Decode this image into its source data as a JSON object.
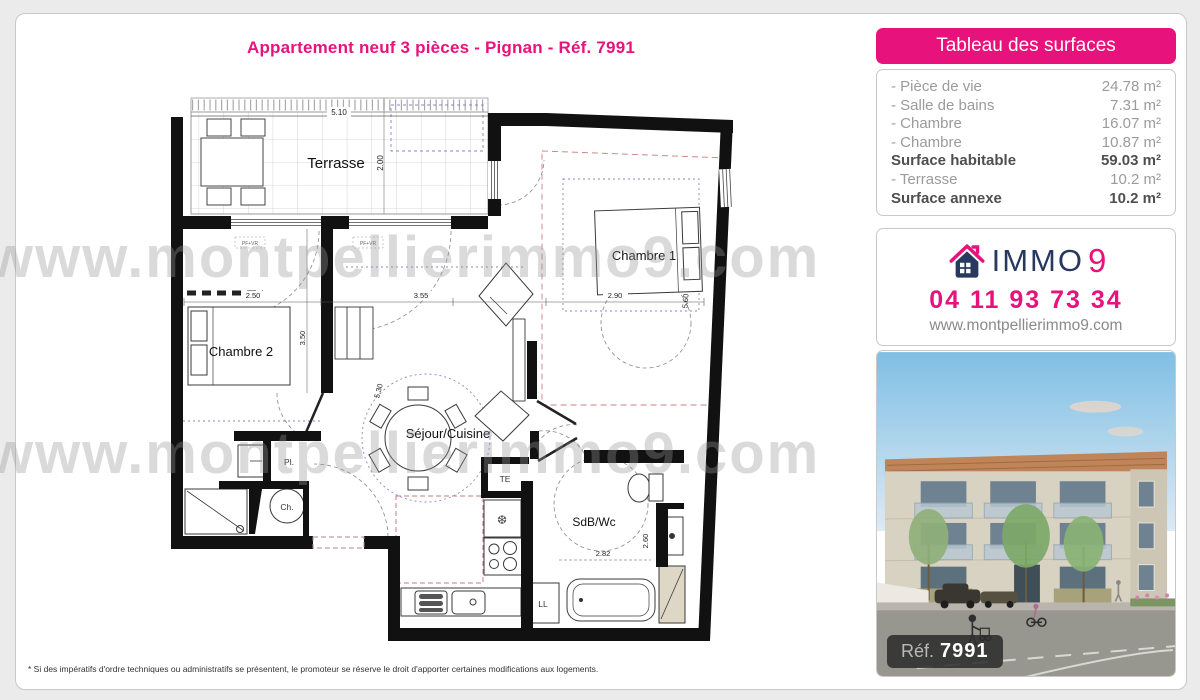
{
  "page": {
    "title": "Appartement neuf 3 pièces - Pignan - Réf. 7991"
  },
  "watermark": {
    "text": "www.montpellierimmo9.com"
  },
  "surfaces": {
    "header": "Tableau des surfaces",
    "rows": [
      {
        "label": "- Pièce de vie",
        "value": "24.78 m²",
        "bold": false
      },
      {
        "label": "- Salle de bains",
        "value": "7.31 m²",
        "bold": false
      },
      {
        "label": "- Chambre",
        "value": "16.07 m²",
        "bold": false
      },
      {
        "label": "- Chambre",
        "value": "10.87 m²",
        "bold": false
      },
      {
        "label": "Surface habitable",
        "value": "59.03 m²",
        "bold": true
      },
      {
        "label": "- Terrasse",
        "value": "10.2 m²",
        "bold": false
      },
      {
        "label": "Surface annexe",
        "value": "10.2 m²",
        "bold": true
      }
    ]
  },
  "agency": {
    "brand_immo": "IMMO",
    "brand_9": "9",
    "phone": "04 11 93 73 34",
    "website": "www.montpellierimmo9.com"
  },
  "photo": {
    "ref_label": "Réf.",
    "ref_value": "7991"
  },
  "plan": {
    "rooms": {
      "terrasse": "Terrasse",
      "chambre1": "Chambre 1",
      "chambre2": "Chambre 2",
      "sejour": "Séjour/Cuisine",
      "sdb": "SdB/Wc",
      "placard": "Pl.",
      "chauffe": "Ch.",
      "te": "TE",
      "ll": "LL"
    },
    "dims": {
      "terrace_w": "5.10",
      "terrace_d": "2.00",
      "win_left": "2.50",
      "win_mid": "3.55",
      "bed1_w": "2.90",
      "ch2_d": "3.50",
      "sejour_d": "5.30",
      "ch1_d": "5.60",
      "sdb_w": "2.82",
      "sdb_d": "2.60"
    },
    "window_tag": "PF+VR"
  },
  "footer": {
    "disclaimer": "* Si des impératifs d'ordre techniques ou administratifs se présentent, le promoteur se réserve le droit d'apporter certaines modifications aux logements."
  },
  "colors": {
    "pink": "#e8127c",
    "navy": "#27395f"
  }
}
